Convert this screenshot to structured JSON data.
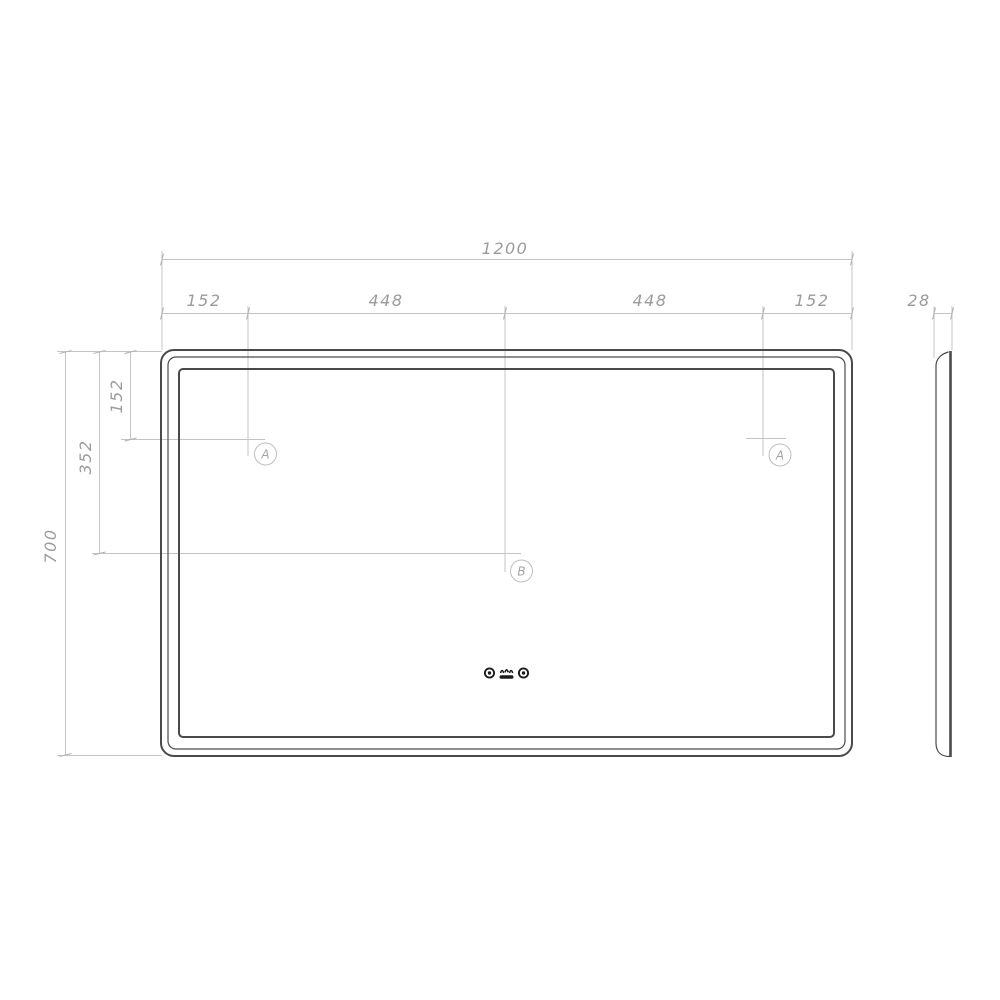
{
  "drawing": {
    "type": "technical-drawing",
    "subject": "LED mirror with touch controls, front view and side profile with mounting dimensions",
    "units": "mm",
    "colors": {
      "background": "#ffffff",
      "outline": "#4a4a4a",
      "dim_line": "#c4c4c4",
      "dim_text": "#9b9b9b",
      "marker": "#a3a3a3",
      "icon": "#1c1c1c"
    },
    "front_view": {
      "dim_total_width": "1200",
      "dim_seg_left": "152",
      "dim_seg_mid_left": "448",
      "dim_seg_mid_right": "448",
      "dim_seg_right": "152",
      "dim_total_height": "700",
      "dim_height_to_center": "352",
      "dim_height_to_top_holes": "152",
      "marker_left": "A",
      "marker_right": "A",
      "marker_center": "B"
    },
    "side_view": {
      "dim_depth": "28"
    },
    "icons": {
      "left": "touch-sensor-button",
      "middle": "anti-fog-heater",
      "right": "touch-sensor-button"
    }
  }
}
